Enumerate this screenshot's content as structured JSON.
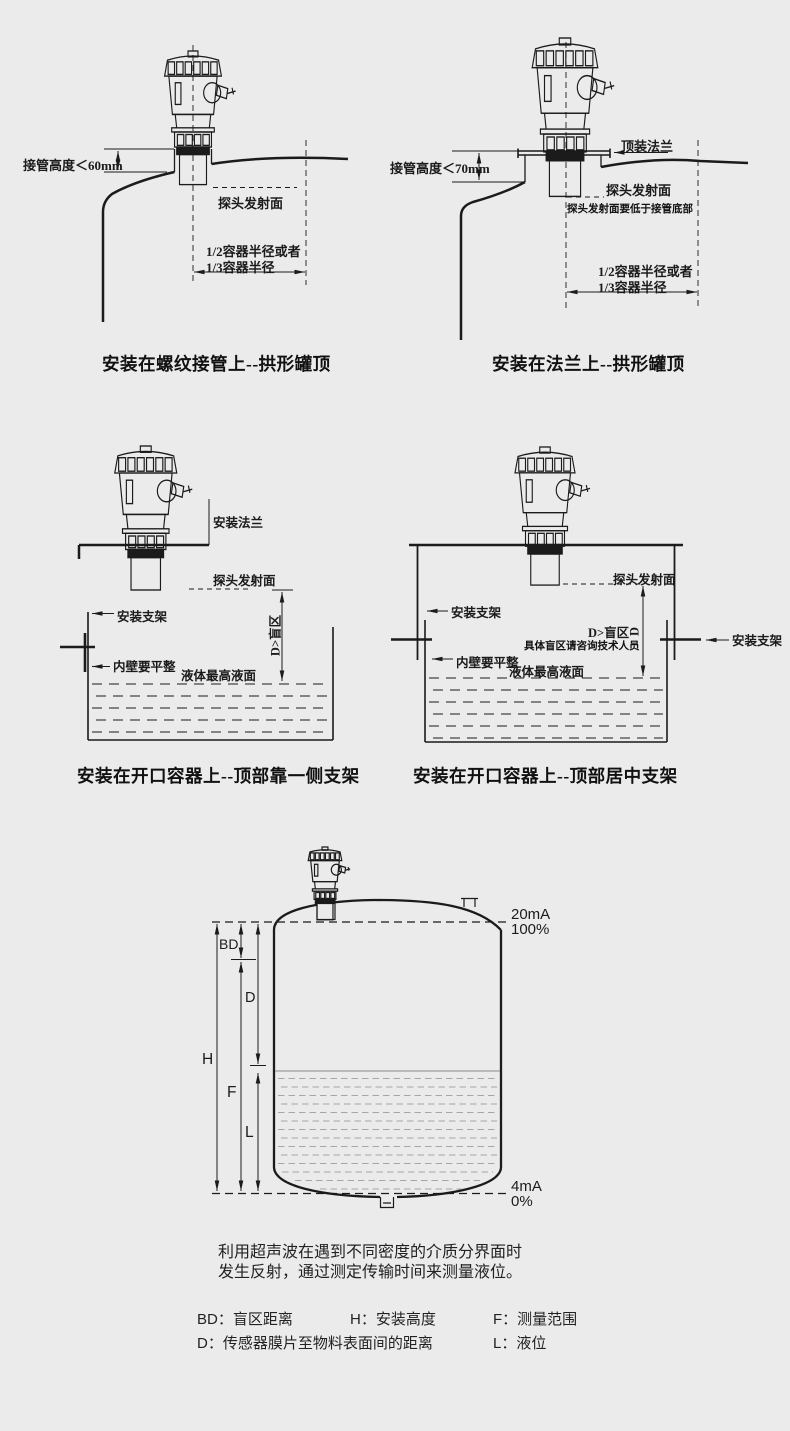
{
  "colors": {
    "background": "#ebebeb",
    "line": "#1b1b1b",
    "liquid_dash": "#a6a6a6"
  },
  "d1": {
    "caption": "安装在螺纹接管上--拱形罐顶",
    "pipe_height": "接管高度＜60mm",
    "probe_surface": "探头发射面",
    "radius1": "1/2容器半径或者",
    "radius2": "1/3容器半径"
  },
  "d2": {
    "caption": "安装在法兰上--拱形罐顶",
    "top_flange": "顶装法兰",
    "pipe_height": "接管高度＜70mm",
    "probe_surface": "探头发射面",
    "probe_note": "探头发射面要低于接管底部",
    "radius1": "1/2容器半径或者",
    "radius2": "1/3容器半径"
  },
  "d3": {
    "caption": "安装在开口容器上--顶部靠一侧支架",
    "mount_flange": "安装法兰",
    "probe_surface": "探头发射面",
    "bracket": "安装支架",
    "blind": "D>盲区",
    "wall": "内壁要平整",
    "level": "液体最高液面"
  },
  "d4": {
    "caption": "安装在开口容器上--顶部居中支架",
    "probe_surface": "探头发射面",
    "bracket_left": "安装支架",
    "bracket_right": "安装支架",
    "blind": "D>盲区",
    "blind_d": "D",
    "blind_note": "具体盲区请咨询技术人员",
    "wall": "内壁要平整",
    "level": "液体最高液面"
  },
  "d5": {
    "bd": "BD",
    "d": "D",
    "h": "H",
    "f": "F",
    "l": "L",
    "top_ma": "20mA",
    "top_pct": "100%",
    "bot_ma": "4mA",
    "bot_pct": "0%"
  },
  "desc": {
    "line1": "利用超声波在遇到不同密度的介质分界面时",
    "line2": "发生反射，通过测定传输时间来测量液位。"
  },
  "legend": {
    "bd": "BD：盲区距离",
    "h": "H：安装高度",
    "f": "F：测量范围",
    "d": "D：传感器膜片至物料表面间的距离",
    "l": "L：液位"
  }
}
